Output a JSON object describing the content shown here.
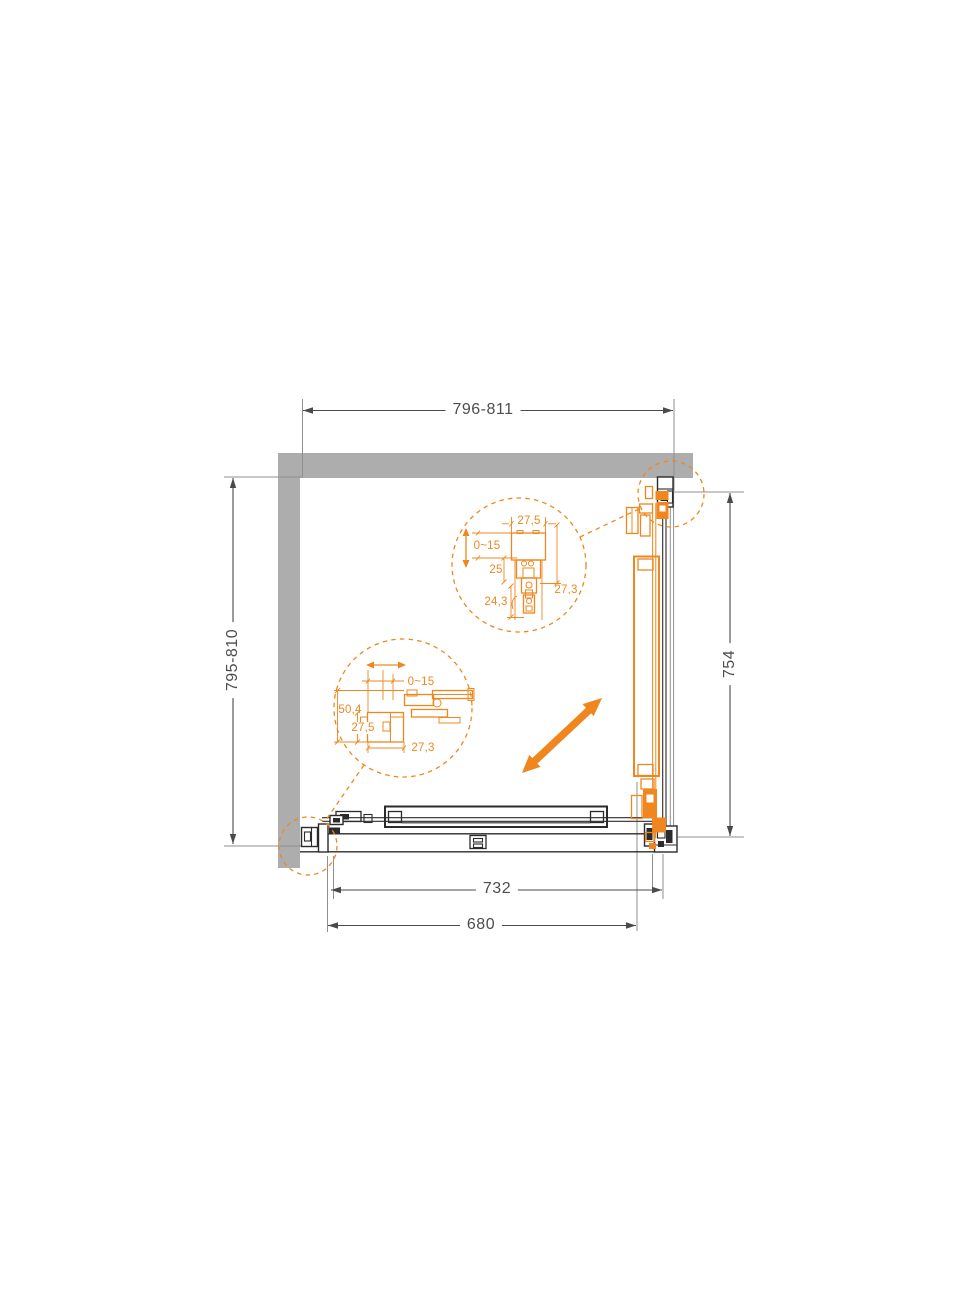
{
  "colors": {
    "accent": "#EF871E",
    "wall": "#ADADAD",
    "line-dark": "#2B2B2B",
    "line-gray": "#8F8F8F",
    "dim-line": "#4A4A4A",
    "dim-text": "#4D4D4D"
  },
  "dimensions": {
    "top_width": "796-811",
    "left_depth": "795-810",
    "right_height": "754",
    "bottom_outer": "732",
    "bottom_inner": "680"
  },
  "detail_top": {
    "width": "27,5",
    "adjust": "0~15",
    "offset": "25",
    "depth": "27,3",
    "bottom": "24,3"
  },
  "detail_side": {
    "adjust": "0~15",
    "height": "50,4",
    "profile": "27,5",
    "width": "27,3"
  },
  "icons": {
    "open_direction": "diagonal-double-arrow",
    "adjust_vertical": "vertical-double-arrow",
    "adjust_horizontal": "horizontal-double-arrow"
  }
}
